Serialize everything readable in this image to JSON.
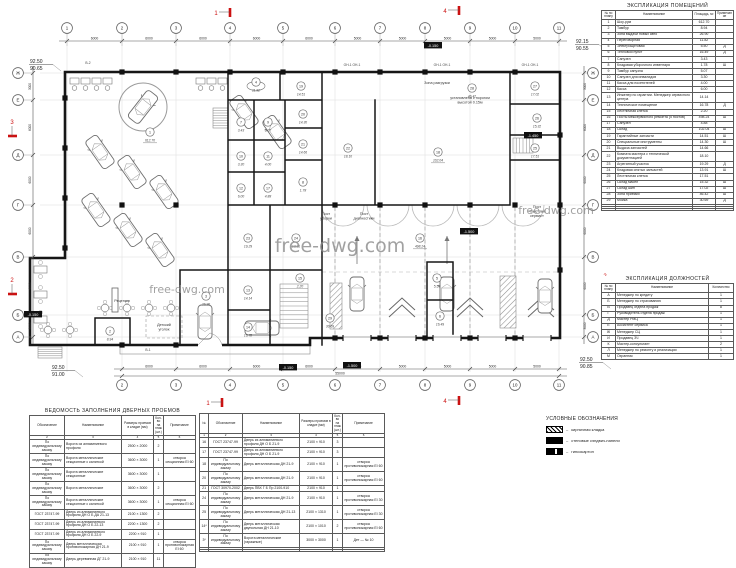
{
  "plan": {
    "watermarks": [
      "free-dwg.com",
      "free-dwg.com",
      "free-dwg.com"
    ],
    "axes_top": [
      "1",
      "2",
      "3",
      "4",
      "5",
      "6",
      "7",
      "8",
      "9",
      "10",
      "11"
    ],
    "axes_bottom": [
      "2",
      "3",
      "4",
      "5",
      "6",
      "7",
      "8",
      "9",
      "10",
      "11"
    ],
    "axes_side": [
      "Ж",
      "Е",
      "Д",
      "Г",
      "В",
      "Б",
      "А"
    ],
    "dims_top": [
      "6000",
      "6000",
      "6000",
      "6000",
      "6000",
      "5000",
      "5000",
      "5000",
      "5000",
      "5000"
    ],
    "dims_bottom": [
      "6000",
      "6000",
      "6000",
      "6000",
      "5000",
      "5000",
      "5000",
      "5000",
      "5000"
    ],
    "dims_bottom_total": "55000",
    "dims_side": [
      "3000",
      "6000",
      "6000",
      "6000",
      "6000",
      "3000"
    ],
    "dims_side_total": "30000",
    "elevations": [
      {
        "upper": "92.50",
        "lower": "90.65"
      },
      {
        "upper": "92.15",
        "lower": "90.55"
      },
      {
        "upper": "92.50",
        "lower": "91.00"
      },
      {
        "upper": "92.50",
        "lower": "90.85"
      }
    ],
    "level_tags": [
      "-0.150",
      "-1.450",
      "-0.150",
      "-0.150",
      "-1.500",
      "-1.500"
    ],
    "section_marks": [
      "1",
      "4",
      "1",
      "4",
      "3",
      "2",
      "3",
      "2"
    ],
    "wall_labels": [
      "ОН-1  ОН-1",
      "ОН-1  ОН-1",
      "ОН-1  ОН-1",
      "В-2",
      "В-1"
    ],
    "text_labels": [
      [
        "Зона разгрузки"
      ],
      [
        "Пост",
        "уборки"
      ],
      [
        "Пост",
        "диагностики"
      ],
      [
        "Пост",
        "«Быстрый",
        "сервис»"
      ],
      [
        "Рецепшн"
      ],
      [
        "Детский",
        "уголок"
      ],
      [
        "установлена с порогом",
        "высотой 0.15м"
      ]
    ],
    "rooms": [
      {
        "n": "1",
        "area": "612.70"
      },
      {
        "n": "2",
        "area": "8.94"
      },
      {
        "n": "3",
        "area": "26.90"
      },
      {
        "n": "4",
        "area": "11.82"
      },
      {
        "n": "5",
        "area": "5.50"
      },
      {
        "n": "6",
        "area": "16.49"
      },
      {
        "n": "7",
        "area": "3.43"
      },
      {
        "n": "8",
        "area": "1.78"
      },
      {
        "n": "9",
        "area": "5.07"
      },
      {
        "n": "10",
        "area": "3.30"
      },
      {
        "n": "11",
        "area": "4.00"
      },
      {
        "n": "12",
        "area": "6.00"
      },
      {
        "n": "13",
        "area": "14.14"
      },
      {
        "n": "14",
        "area": "16.78"
      },
      {
        "n": "15",
        "area": "2.20"
      },
      {
        "n": "16",
        "area": "498.24"
      },
      {
        "n": "17",
        "area": "4.88"
      },
      {
        "n": "18",
        "area": "102.04"
      },
      {
        "n": "19",
        "area": "14.51"
      },
      {
        "n": "20",
        "area": "14.30"
      },
      {
        "n": "21",
        "area": "14.66"
      },
      {
        "n": "22",
        "area": "18.10"
      },
      {
        "n": "23",
        "area": "19.29"
      },
      {
        "n": "24",
        "area": "13.91"
      },
      {
        "n": "25",
        "area": "17.51"
      },
      {
        "n": "26",
        "area": "15.32"
      },
      {
        "n": "27",
        "area": "17.02"
      },
      {
        "n": "28",
        "area": "46.42"
      },
      {
        "n": "29",
        "area": "30.69"
      }
    ]
  },
  "explication_rooms": {
    "title": "ЭКСПЛИКАЦИЯ ПОМЕЩЕНИЙ",
    "headers": [
      "№ по плану",
      "Наименование",
      "Площадь, м²",
      "Примечание"
    ],
    "rows": [
      [
        "1",
        "Шоу-рум",
        "612.70",
        ""
      ],
      [
        "2",
        "Тамбур",
        "8.94",
        ""
      ],
      [
        "3",
        "Зона выдачи новых авто",
        "26.90",
        ""
      ],
      [
        "4",
        "Переговорная",
        "11.82",
        ""
      ],
      [
        "5",
        "Электрощитовая",
        "5.50",
        "Д"
      ],
      [
        "6",
        "Тепловой пункт",
        "16.49",
        "Д"
      ],
      [
        "7",
        "Санузел",
        "3.43",
        ""
      ],
      [
        "8",
        "Кладовая уборочного инвентаря",
        "1.78",
        "Ш"
      ],
      [
        "9",
        "Тамбур санузла",
        "5.07",
        ""
      ],
      [
        "10",
        "Санузел для инвалидов",
        "3.30",
        ""
      ],
      [
        "11",
        "Касса для посетителей",
        "4.00",
        ""
      ],
      [
        "12",
        "Касса",
        "6.00",
        ""
      ],
      [
        "13",
        "Инженер по гарантии. Менеджер сервисного центра",
        "14.14",
        ""
      ],
      [
        "14",
        "Техническое помещение",
        "16.78",
        "Д"
      ],
      [
        "15",
        "Лестничная клетка",
        "2.20",
        ""
      ],
      [
        "16",
        "Посты межсервисного ремонта (5 постов)",
        "498.24",
        "Ш"
      ],
      [
        "17",
        "Санузел",
        "4.88",
        ""
      ],
      [
        "18",
        "Склад",
        "102.04",
        "Ш"
      ],
      [
        "19",
        "Гарантийные запчасти",
        "14.51",
        "Ш"
      ],
      [
        "20",
        "Специальные инструменты",
        "14.30",
        "Ш"
      ],
      [
        "21",
        "Выдача запчастей",
        "14.66",
        ""
      ],
      [
        "22",
        "Комната мастера с технической документацией",
        "18.10",
        ""
      ],
      [
        "23",
        "Агрегатный участок",
        "19.29",
        "Д"
      ],
      [
        "24",
        "Кладовая снятых запчастей",
        "13.91",
        "Ш"
      ],
      [
        "25",
        "Лестничная клетка",
        "17.51",
        ""
      ],
      [
        "26",
        "Склад масел",
        "15.32",
        "Ш"
      ],
      [
        "27",
        "Склад шин",
        "17.02",
        "Ш"
      ],
      [
        "28",
        "Зона приемки",
        "46.42",
        "Ш"
      ],
      [
        "29",
        "Мойка",
        "30.69",
        "Д"
      ],
      [
        "",
        "",
        "",
        ""
      ],
      [
        "",
        "",
        "",
        ""
      ],
      [
        "",
        "",
        "",
        ""
      ]
    ]
  },
  "explication_staff": {
    "title": "ЭКСПЛИКАЦИЯ ДОЛЖНОСТЕЙ",
    "headers": [
      "№ по плану",
      "Наименование",
      "Количество"
    ],
    "rows": [
      [
        "А",
        "Менеджер по кредиту",
        "1"
      ],
      [
        "Б",
        "Менеджер по страхованию",
        "1"
      ],
      [
        "В",
        "Продавец отдела продаж",
        "8"
      ],
      [
        "Г",
        "Руководитель отдела продаж",
        "1"
      ],
      [
        "Д",
        "Мастер РМЦ",
        "1"
      ],
      [
        "Е",
        "Ассистент сервиса",
        "1"
      ],
      [
        "Ж",
        "Менеджер СЦ",
        "1"
      ],
      [
        "И",
        "Продавец ЗЧ",
        "1"
      ],
      [
        "К",
        "Мастер-консультант",
        "2"
      ],
      [
        "Л",
        "Менеджер по ремонту и реализации",
        "1"
      ],
      [
        "М",
        "Охранник",
        "1"
      ]
    ]
  },
  "doors_left": {
    "title": "ВЕДОМОСТЬ ЗАПОЛНЕНИЯ ДВЕРНЫХ ПРОЕМОВ",
    "headers": [
      "Обозначение",
      "Наименование",
      "Размеры проемов в кладке (мм)",
      "Кол-во на этаж (шт.)",
      "Примечание"
    ],
    "numbering": [
      "2",
      "3",
      "4",
      "5",
      "6"
    ],
    "rows": [
      [
        "По индивидуальному заказу",
        "Ворота из алюминиевого профиля",
        "2500 × 2000",
        "2",
        ""
      ],
      [
        "По индивидуальному заказу",
        "Ворота металлические секционные с калиткой",
        "3600 × 3000",
        "1",
        "створка секционная EI 60"
      ],
      [
        "По индивидуальному заказу",
        "Ворота металлические секционные",
        "3600 × 3000",
        "1",
        ""
      ],
      [
        "По индивидуальному заказу",
        "Ворота металлические",
        "3600 × 3000",
        "2",
        ""
      ],
      [
        "По индивидуальному заказу",
        "Ворота металлические секционные с калиткой",
        "3600 × 3000",
        "1",
        "створка секционная EI 60"
      ],
      [
        "ГОСТ 23747-99",
        "Дверь из алюминиевого профиля ДН О Б ДА 21-13",
        "2100 × 1300",
        "2",
        ""
      ],
      [
        "ГОСТ 23747-99",
        "Дверь из алюминиевого профиля ДН О Б 22-13",
        "2200 × 1300",
        "2",
        ""
      ],
      [
        "ГОСТ 23747-99",
        "Дверь из алюминиевого профиля ДН О Б 22-9",
        "2200 × 910",
        "1",
        ""
      ],
      [
        "По индивидуальному заказу",
        "Дверь металлическая противопожарная ДН 21-9",
        "2100 × 910",
        "1",
        "створка противопожарная EI 60"
      ],
      [
        "По индивидуальному заказу",
        "Дверь деревянная ДГ 21-9",
        "2100 × 910",
        "11",
        ""
      ]
    ]
  },
  "doors_right": {
    "headers": [
      "№",
      "Обозначение",
      "Наименование",
      "Размеры проемов в кладке (мм)",
      "Кол-во на этаж (шт.)",
      "Примечание"
    ],
    "numbering": [
      "1",
      "2",
      "3",
      "4",
      "5",
      "6"
    ],
    "rows": [
      [
        "16",
        "ГОСТ 23747-99",
        "Дверь из алюминиевого профиля ДН О Б 21-9",
        "2100 × 910",
        "3",
        ""
      ],
      [
        "17",
        "ГОСТ 23747-99",
        "Дверь из алюминиевого профиля ДН О Б 21-9",
        "2100 × 910",
        "3",
        ""
      ],
      [
        "18",
        "По индивидуальному заказу",
        "Дверь металлическая ДН 21-9",
        "2100 × 910",
        "1",
        "створка противопожарная EI 60"
      ],
      [
        "20",
        "По индивидуальному заказу",
        "Дверь металлическая ДН 21-9",
        "2100 × 910",
        "1",
        "створка противопожарная EI 60"
      ],
      [
        "21",
        "ГОСТ 30970-2002",
        "Дверь ПВХ Г Б Пр 2100-910",
        "2100 × 910",
        "1",
        ""
      ],
      [
        "24",
        "По индивидуальному заказу",
        "Дверь металлическая ДН 21-9",
        "2100 × 910",
        "1",
        "створка противопожарная EI 30"
      ],
      [
        "25",
        "По индивидуальному заказу",
        "Дверь металлическая ДН 21-13",
        "2100 × 1310",
        "1",
        "створка противопожарная EI 30"
      ],
      [
        "14*",
        "По индивидуальному заказу",
        "Дверь металлическая двупольная ДН 21-10",
        "2100 × 1010",
        "2",
        "створка противопожарная EI 60"
      ],
      [
        "3*",
        "По индивидуальному заказу",
        "Ворота металлические (гаражные)",
        "3000 × 3000",
        "1",
        "Дет — № 10"
      ],
      [
        "",
        "",
        "",
        "",
        "",
        ""
      ],
      [
        "",
        "",
        "",
        "",
        "",
        ""
      ]
    ]
  },
  "legend": {
    "title": "УСЛОВНЫЕ ОБОЗНАЧЕНИЯ",
    "items": [
      {
        "swatch": "brick-hatch",
        "label": "кирпичная кладка"
      },
      {
        "swatch": "sandwich-panel",
        "label": "стеновые сэндвич-панели"
      },
      {
        "swatch": "drywall",
        "label": "гипсокартон"
      }
    ]
  },
  "colors": {
    "accent_red": "#cc1111",
    "wall": "#161616",
    "thin_line": "#6a6a6a",
    "watermark": "#8a8a8a"
  }
}
